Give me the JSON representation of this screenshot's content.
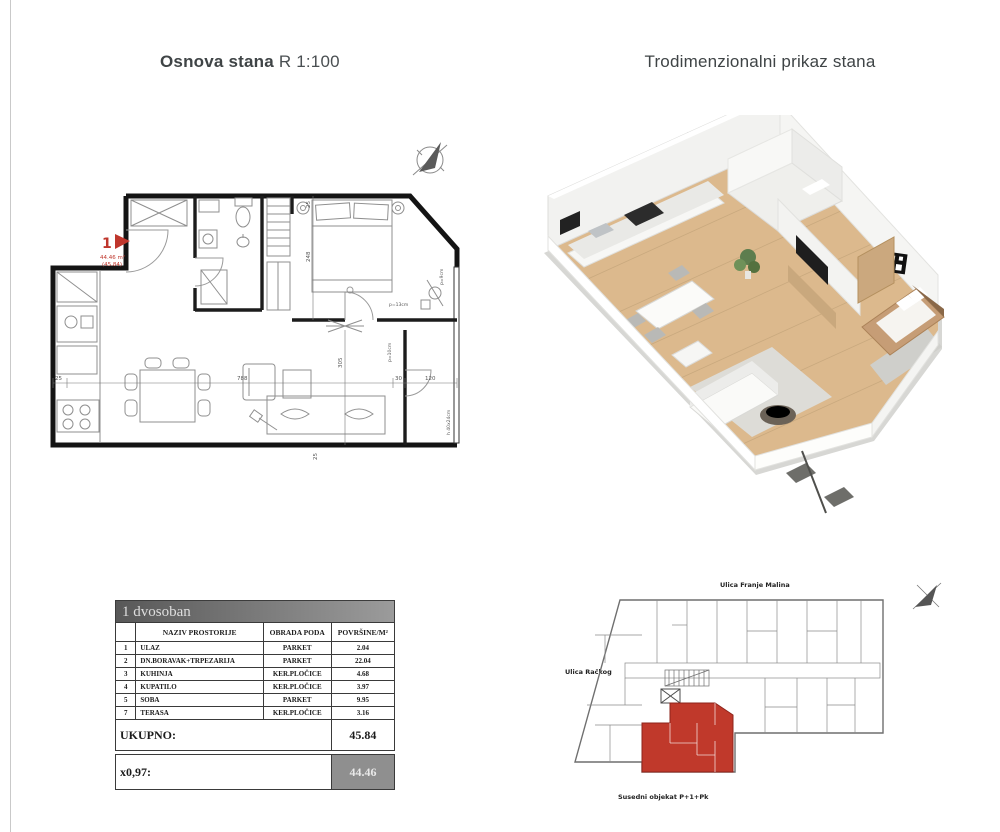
{
  "titles": {
    "plan_bold": "Osnova stana",
    "plan_scale": "R 1:100",
    "render3d": "Trodimenzionalni prikaz stana"
  },
  "floor_plan": {
    "unit_number": "1",
    "area_value": "44.46 m²",
    "area_alt": "(45.84)",
    "dim_left": "25",
    "dim_bottom_main": "788",
    "dim_wall": "30",
    "dim_terrace": "120",
    "dim_v_living": "305",
    "dim_v_bedroom": "248",
    "dim_top_small": "25",
    "dim_bottom_small": "25",
    "note_door1": "p=13cm",
    "note_door2": "p=10cm",
    "note_parapet": "p=9cm",
    "note_sill": "h 40x24cm"
  },
  "table": {
    "title": "1 dvosoban",
    "col_num": "",
    "col_name": "NAZIV PROSTORIJE",
    "col_floor": "OBRADA PODA",
    "col_area": "POVRŠINE/M²",
    "rows": [
      {
        "num": "1",
        "name": "ULAZ",
        "floor": "PARKET",
        "area": "2.04"
      },
      {
        "num": "2",
        "name": "DN.BORAVAK+TRPEZARIJA",
        "floor": "PARKET",
        "area": "22.04"
      },
      {
        "num": "3",
        "name": "KUHINJA",
        "floor": "KER.PLOČICE",
        "area": "4.68"
      },
      {
        "num": "4",
        "name": "KUPATILO",
        "floor": "KER.PLOČICE",
        "area": "3.97"
      },
      {
        "num": "5",
        "name": "SOBA",
        "floor": "PARKET",
        "area": "9.95"
      },
      {
        "num": "7",
        "name": "TERASA",
        "floor": "KER.PLOČICE",
        "area": "3.16"
      }
    ],
    "total_label": "UKUPNO:",
    "total_value": "45.84",
    "factor_label": "x0,97:",
    "factor_value": "44.46"
  },
  "site_plan": {
    "street_top": "Ulica Franje Malina",
    "street_left": "Ulica Račkog",
    "note_bottom": "Susedni objekat P+1+Pk"
  },
  "colors": {
    "accent_red": "#bf362c",
    "site_red": "#c0392b",
    "wood": "#dcb98d",
    "title_gray": "#3f4446"
  }
}
